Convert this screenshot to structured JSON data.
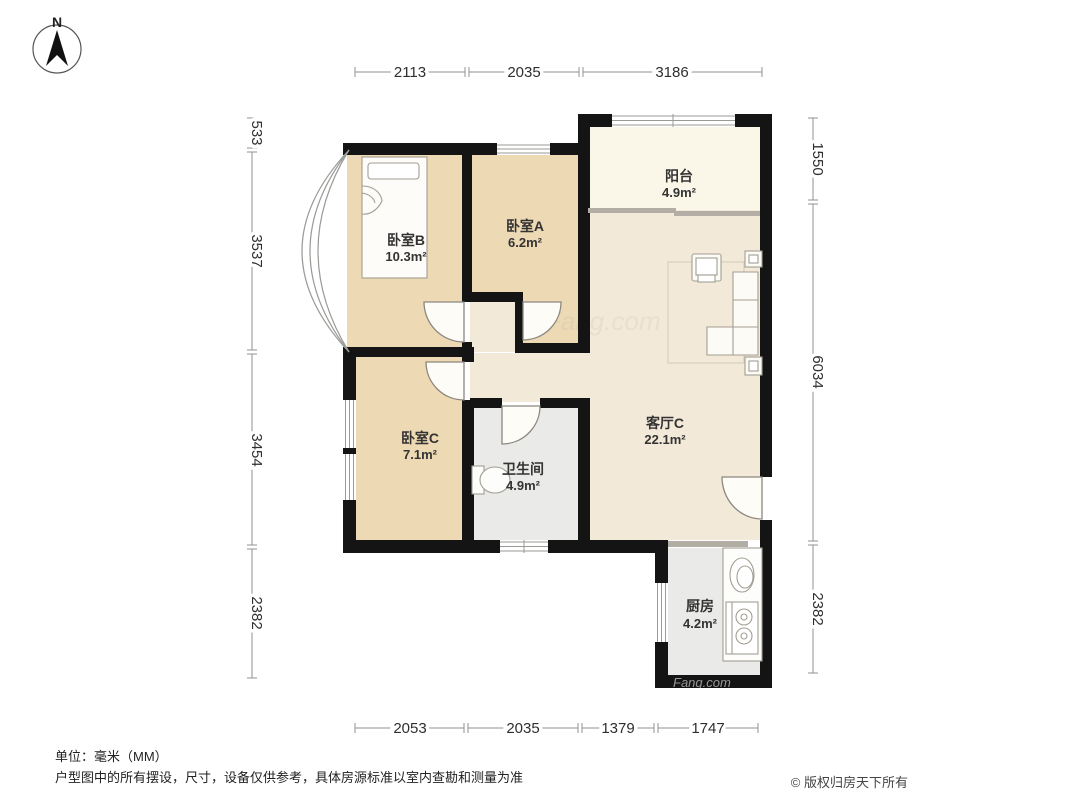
{
  "compass": {
    "north_label": "N"
  },
  "rooms": [
    {
      "name": "卧室B",
      "area": "10.3m²"
    },
    {
      "name": "卧室A",
      "area": "6.2m²"
    },
    {
      "name": "阳台",
      "area": "4.9m²"
    },
    {
      "name": "卧室C",
      "area": "7.1m²"
    },
    {
      "name": "卫生间",
      "area": "4.9m²"
    },
    {
      "name": "客厅C",
      "area": "22.1m²"
    },
    {
      "name": "厨房",
      "area": "4.2m²"
    }
  ],
  "dimensions": {
    "unit": "mm",
    "top": [
      "2113",
      "2035",
      "3186"
    ],
    "bottom": [
      "2053",
      "2035",
      "1379",
      "1747"
    ],
    "left": [
      "533",
      "3537",
      "3454",
      "2382"
    ],
    "right": [
      "1550",
      "6034",
      "2382"
    ]
  },
  "footer": {
    "unit": "单位：毫米（MM）",
    "disclaimer": "户型图中的所有摆设，尺寸，设备仅供参考，具体房源标准以室内查勘和测量为准",
    "copyright": "© 版权归房天下所有"
  },
  "watermark": "Fang.com",
  "colors": {
    "wall": "#141414",
    "bedroom_floor": "#edd9b3",
    "living_floor": "#f3e9d8",
    "balcony_floor": "#faf7e9",
    "utility_floor": "#eaeae8",
    "dimension_line": "#909090"
  }
}
